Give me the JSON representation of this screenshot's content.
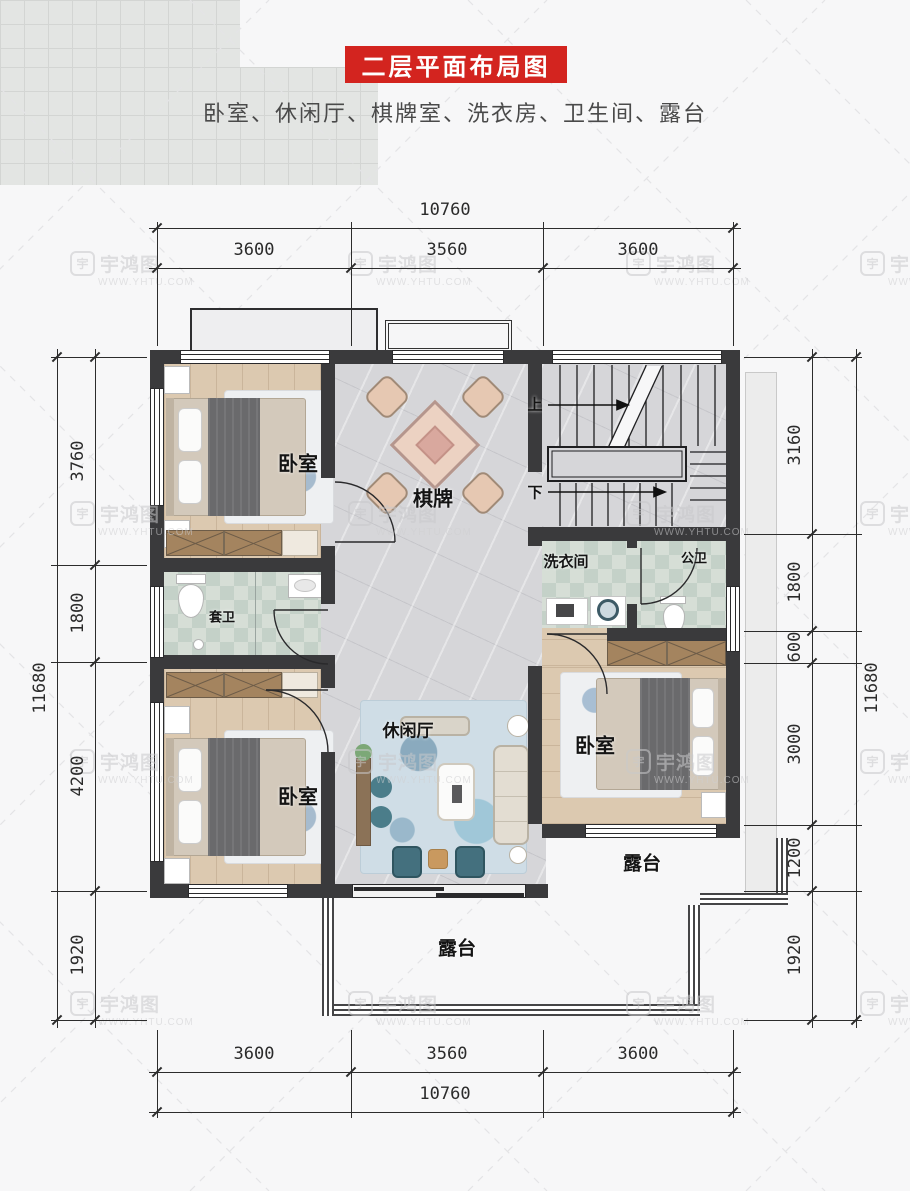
{
  "header": {
    "title": "二层平面布局图",
    "subtitle": "卧室、休闲厅、棋牌室、洗衣房、卫生间、露台"
  },
  "colors": {
    "banner_red": "#d3241f",
    "wall": "#3a3a3c"
  },
  "dimensions": {
    "top": {
      "total": "10760",
      "segments": [
        "3600",
        "3560",
        "3600"
      ]
    },
    "bottom": {
      "total": "10760",
      "segments": [
        "3600",
        "3560",
        "3600"
      ]
    },
    "left": {
      "total": "11680",
      "segments": [
        "3760",
        "1800",
        "4200",
        "1920"
      ]
    },
    "right": {
      "total": "11680",
      "segments": [
        "3160",
        "1800",
        "600",
        "3000",
        "1200",
        "1920"
      ]
    }
  },
  "rooms": {
    "bedroom1": "卧室",
    "bedroom2": "卧室",
    "bedroom3": "卧室",
    "chess": "棋牌",
    "leisure": "休闲厅",
    "laundry": "洗衣间",
    "public_bath": "公卫",
    "ensuite_bath": "套卫",
    "terrace_bottom": "露台",
    "terrace_right": "露台"
  },
  "stairs": {
    "up": "上",
    "down": "下"
  },
  "watermark": {
    "brand": "宇鸿图",
    "site": "WWW.YHTU.COM"
  }
}
